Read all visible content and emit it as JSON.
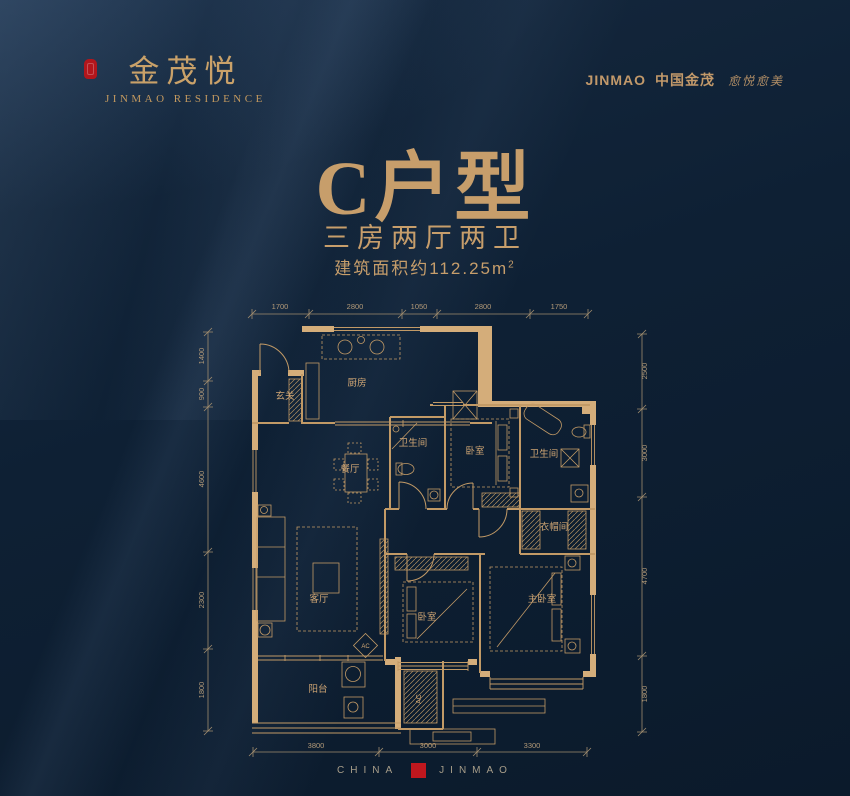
{
  "brand": {
    "name_cn": "金茂悦",
    "name_en": "JINMAO RESIDENCE",
    "corp_wordmark": "JINMAO",
    "corp_cn": "中国金茂",
    "corp_slogan": "愈悦愈美"
  },
  "title": {
    "unit": "C户型",
    "layout": "三房两厅两卫",
    "area_prefix": "建筑面积约112.25m",
    "area_sup": "2"
  },
  "plan": {
    "rooms": {
      "entry": "玄关",
      "kitchen": "厨房",
      "dining": "餐厅",
      "bath1": "卫生间",
      "bedroom2": "卧室",
      "bath2": "卫生间",
      "cloakroom": "衣帽间",
      "living": "客厅",
      "bedroom3": "卧室",
      "master": "主卧室",
      "balcony": "阳台"
    },
    "ac_label": "AC",
    "dims": {
      "top": [
        "1700",
        "2800",
        "1050",
        "2800",
        "1750"
      ],
      "left": [
        "1400",
        "900",
        "4600",
        "2300",
        "1800"
      ],
      "right": [
        "2500",
        "3000",
        "4700",
        "1800"
      ],
      "bottom": [
        "3800",
        "3000",
        "3300"
      ]
    }
  },
  "footer": {
    "country": "CHINA",
    "company": "JINMAO"
  },
  "colors": {
    "gold": "#c79e6c",
    "red": "#b3161c",
    "background": "#0d1e33"
  }
}
